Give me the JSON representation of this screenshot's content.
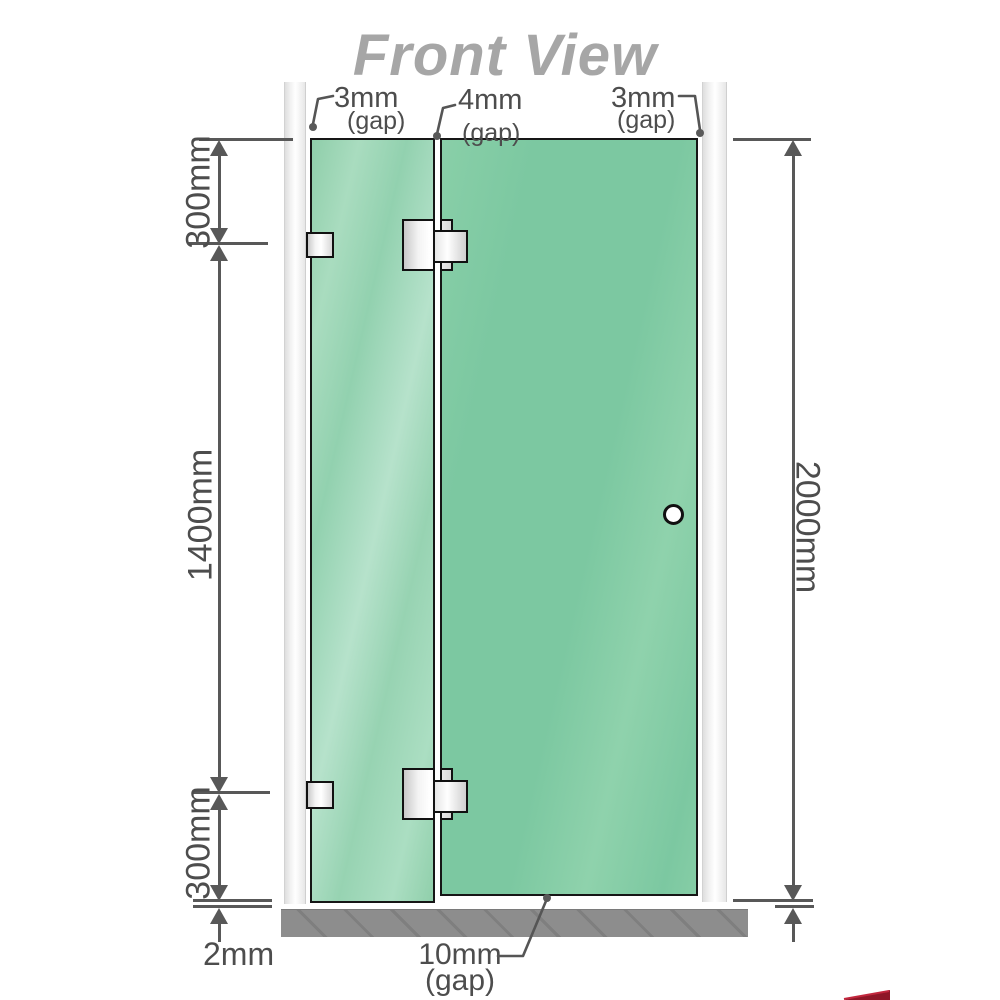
{
  "title": "Front View",
  "top_annotations": [
    {
      "value": "3mm",
      "suffix": "(gap)"
    },
    {
      "value": "4mm",
      "suffix": "(gap)"
    },
    {
      "value": "3mm",
      "suffix": "(gap)"
    }
  ],
  "left_dimensions": {
    "upper": "300mm",
    "middle": "1400mm",
    "lower": "300mm",
    "floor_gap": "2mm"
  },
  "right_dimension": "2000mm",
  "bottom_annotation": {
    "value": "10mm",
    "suffix": "(gap)"
  },
  "colors": {
    "glass_fixed": "#9bd4b4",
    "glass_door": "#7cc8a1",
    "glass_border": "#161616",
    "wall_channel": "#e9e9e9",
    "floor": "#8d8d8d",
    "dim_line": "#585858",
    "dim_text": "#4d4d4d",
    "title_text": "#a6a6a6",
    "hardware_border": "#111111",
    "logo_red": "#8e1627"
  }
}
